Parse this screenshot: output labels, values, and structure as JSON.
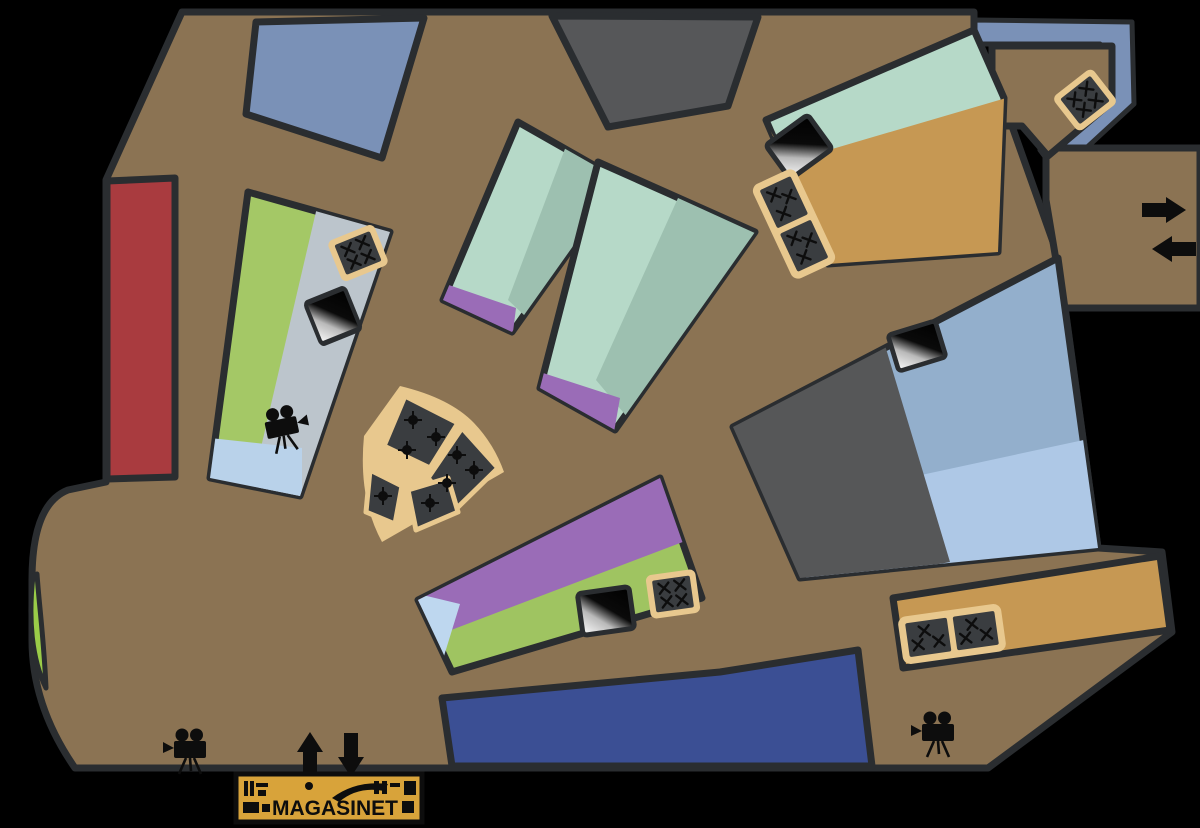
{
  "app": {
    "title": "Magasinet venue floor plan"
  },
  "logo": {
    "text": "MAGASINET"
  },
  "colors": {
    "background": "#000000",
    "floor": "#8b7353",
    "wall": "#2a2d30",
    "gold": "#e8c88e",
    "seating_dark": "#3a3d40",
    "red_room": "#a93b3f",
    "slate_room": "#7a91b7",
    "dark_room": "#565759",
    "mint": "#b6d9c8",
    "mint_shade": "#9dc0b0",
    "purple": "#9a6cb7",
    "green_room": "#a4c866",
    "panel_gray": "#bcc5cc",
    "panel_blue": "#b9d2ea",
    "bottom_green": "#9fc461",
    "bottom_blue": "#bed7ef",
    "royal_blue": "#3b4f94",
    "orange": "#c69853",
    "big_dark": "#565758",
    "big_blue_top": "#93afcc",
    "big_blue_bottom": "#aec8e6",
    "band_blue": "#7a91b7",
    "crescent_green": "#9acc48",
    "logo_gold": "#d8a33a",
    "icon_black": "#0d0d0d"
  },
  "icons": {
    "film_camera": "movie-camera (3 on plan)",
    "screen": "projection-screen (4 on plan)",
    "table_group": "table-with-chairs seating block (6 on plan)",
    "round_table": "round table with chairs (fan seating, 8 marks)",
    "arrow_right": "→",
    "arrow_left": "←",
    "arrow_up": "↑",
    "arrow_down": "↓"
  }
}
